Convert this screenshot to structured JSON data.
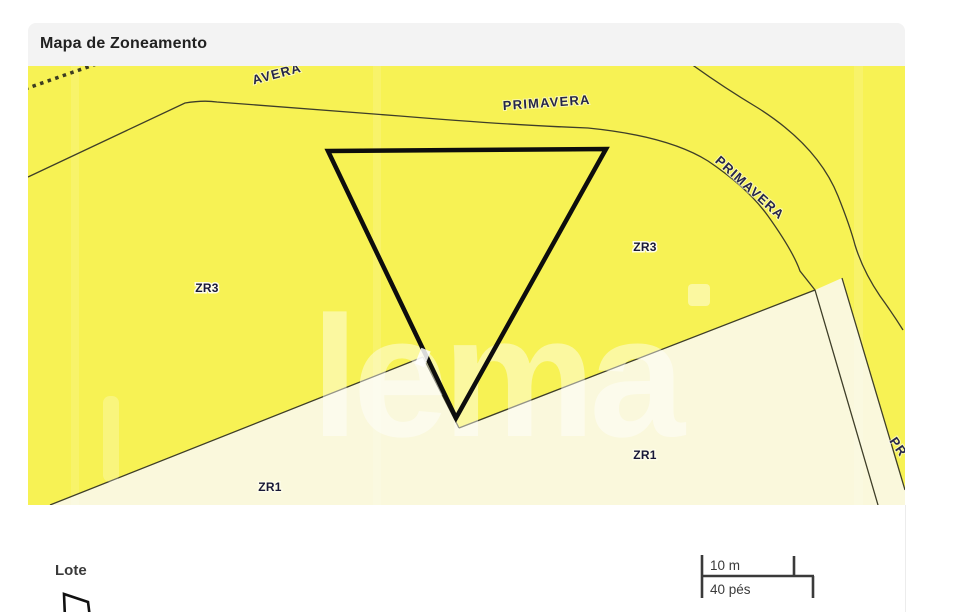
{
  "header": {
    "title": "Mapa de Zoneamento"
  },
  "map": {
    "zone_labels": {
      "zr3_left": "ZR3",
      "zr3_right": "ZR3",
      "zr1_left": "ZR1",
      "zr1_right": "ZR1"
    },
    "street_labels": {
      "partial_top": "AVERA",
      "top": "PRIMAVERA",
      "right": "PRIMAVERA",
      "partial_right": "PR"
    },
    "watermark": "lema",
    "colors": {
      "zr3_fill": "#F7F254",
      "zr1_fill": "#FAF8DC",
      "road_line": "#3E3E28",
      "lot_outline": "#0D0D0D",
      "zone_label": "#181838",
      "street_label": "#26264A"
    }
  },
  "legend": {
    "lote_label": "Lote",
    "scale": {
      "metric": "10 m",
      "imperial": "40 pés"
    }
  }
}
